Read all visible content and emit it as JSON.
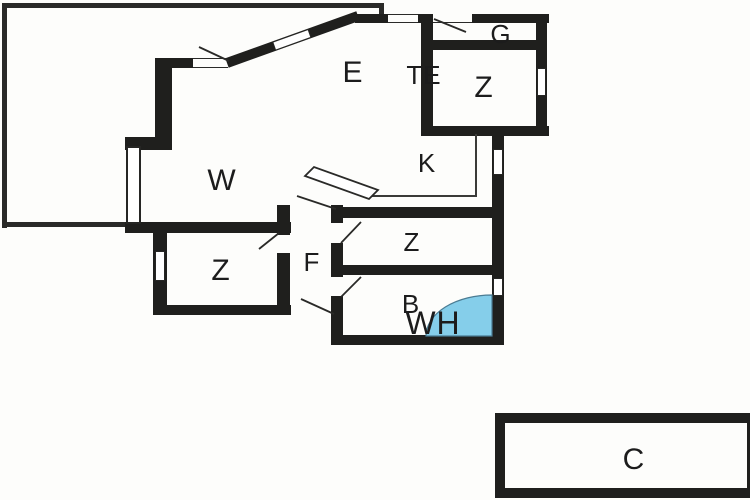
{
  "title": "Floor plan",
  "rooms": {
    "w": {
      "label": "W"
    },
    "e": {
      "label": "E"
    },
    "te": {
      "label": "TE"
    },
    "g": {
      "label": "G"
    },
    "z_top": {
      "label": "Z"
    },
    "k": {
      "label": "K"
    },
    "z_left": {
      "label": "Z"
    },
    "f": {
      "label": "F"
    },
    "z_mid": {
      "label": "Z"
    },
    "b": {
      "label": "B"
    },
    "wh": {
      "label": "WH"
    },
    "c": {
      "label": "C"
    }
  },
  "colors": {
    "wall": "#1f1f1d",
    "line": "#2a2a28",
    "background": "#fdfdfb",
    "door_swing_fill": "#85ceea",
    "label": "#1c1c1c"
  }
}
